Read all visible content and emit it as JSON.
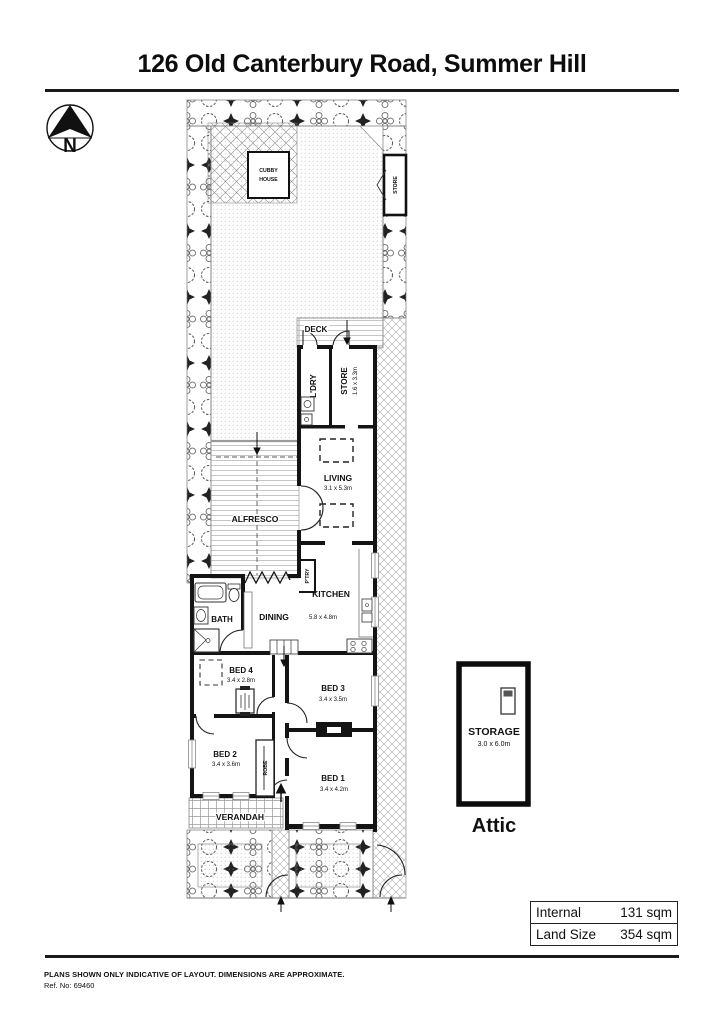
{
  "title": "126 Old Canterbury Road, Summer Hill",
  "compass": {
    "label": "N"
  },
  "plan": {
    "cubby_house": {
      "line1": "CUBBY",
      "line2": "HOUSE"
    },
    "garden_store": {
      "name": "STORE"
    },
    "deck": {
      "name": "DECK"
    },
    "laundry": {
      "name": "L'DRY"
    },
    "store": {
      "name": "STORE",
      "dims": "1.6 x 3.3m"
    },
    "living": {
      "name": "LIVING",
      "dims": "3.1 x 5.3m"
    },
    "alfresco": {
      "name": "ALFRESCO"
    },
    "pantry": {
      "name": "P'TRY"
    },
    "kitchen": {
      "name": "KITCHEN"
    },
    "dining": {
      "name": "DINING"
    },
    "kitchen_dining_dims": "5.8 x 4.8m",
    "bath": {
      "name": "BATH"
    },
    "bed4": {
      "name": "BED 4",
      "dims": "3.4 x 2.8m"
    },
    "bed3": {
      "name": "BED 3",
      "dims": "3.4 x 3.5m"
    },
    "bed2": {
      "name": "BED 2",
      "dims": "3.4 x 3.6m"
    },
    "bed1": {
      "name": "BED 1",
      "dims": "3.4 x 4.2m"
    },
    "robe": {
      "name": "ROBE"
    },
    "verandah": {
      "name": "VERANDAH"
    }
  },
  "attic": {
    "name": "STORAGE",
    "dims": "3.0 x 6.0m",
    "caption": "Attic"
  },
  "summary": {
    "rows": [
      {
        "label": "Internal",
        "value": "131 sqm"
      },
      {
        "label": "Land Size",
        "value": "354 sqm"
      }
    ]
  },
  "footer": {
    "disclaimer": "PLANS SHOWN ONLY INDICATIVE OF LAYOUT.  DIMENSIONS ARE APPROXIMATE.",
    "ref": "Ref. No: 69460"
  }
}
